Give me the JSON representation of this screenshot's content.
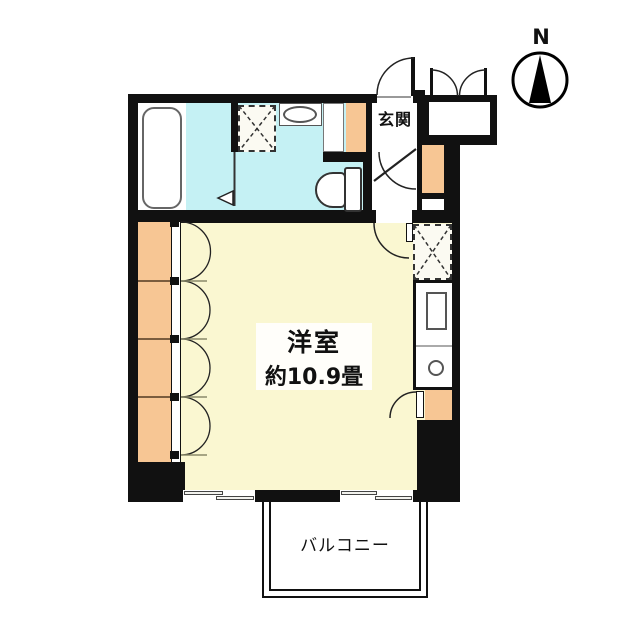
{
  "labels": {
    "north": "N",
    "entrance": "玄関",
    "main_room_name": "洋室",
    "main_room_size": "約10.9畳",
    "balcony": "バルコニー"
  },
  "colors": {
    "wall": "#111111",
    "main_room_floor": "#FAF7D1",
    "wet_area_floor": "#C5F1F4",
    "column": "#F7C694",
    "floor_white": "#FFFFFF",
    "fixture_outline": "#555555"
  },
  "fixtures": [
    {
      "name": "bathtub"
    },
    {
      "name": "washing-machine-pan"
    },
    {
      "name": "wash-basin"
    },
    {
      "name": "toilet"
    },
    {
      "name": "entrance-door"
    },
    {
      "name": "storage-double-doors"
    },
    {
      "name": "closet"
    },
    {
      "name": "kitchen-counter"
    },
    {
      "name": "balcony-sliding-windows"
    },
    {
      "name": "casement-windows"
    },
    {
      "name": "compass-north"
    }
  ]
}
